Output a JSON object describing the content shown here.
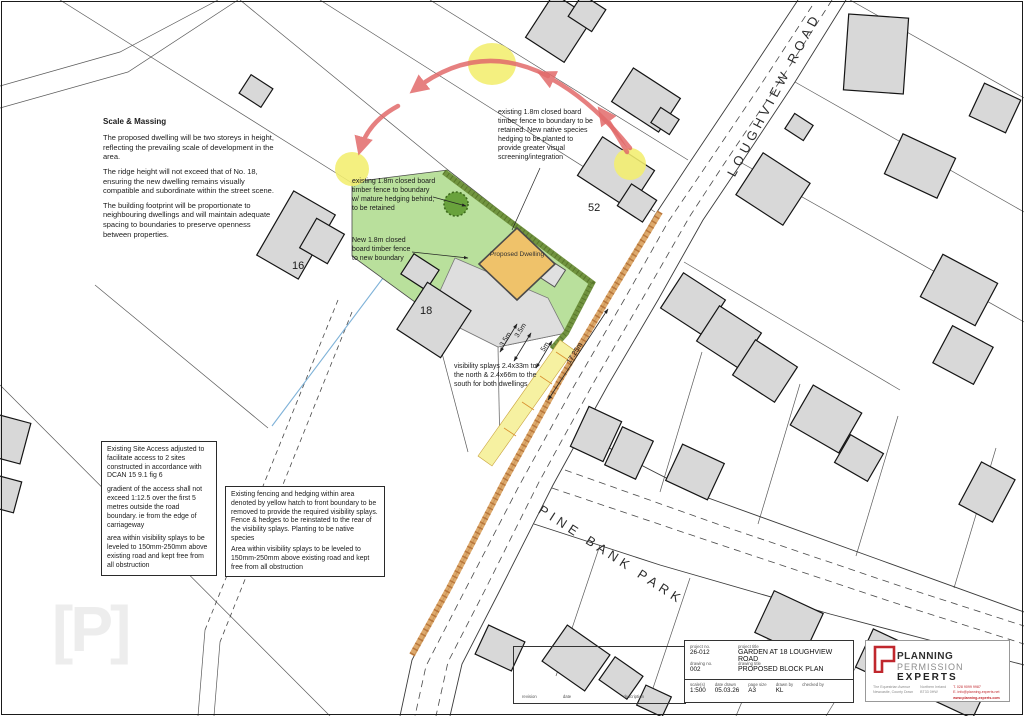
{
  "drawing": {
    "scale_massing": {
      "heading": "Scale & Massing",
      "p1": "The proposed dwelling will be two storeys in height, reflecting the prevailing scale of development in the area.",
      "p2": "The ridge height will not exceed that of No. 18, ensuring the new dwelling remains visually compatible and subordinate within the street scene.",
      "p3": "The building footprint will be proportionate to neighbouring dwellings and will maintain adequate spacing to boundaries to preserve openness between properties."
    },
    "notes": {
      "fence_retained": "existing 1.8m closed board timber fence to boundary to be retained. New native species hedging to be planted to provide greater visual screening/integration",
      "fence_mature": "existing 1.8m closed board timber fence to boundary w/ mature hedging behind, to be retained",
      "new_fence": "New 1.8m closed board timber fence to new boundary",
      "visibility": "visibility splays 2.4x33m to the north & 2.4x66m to the south for both dwellings"
    },
    "access_box": {
      "p1": "Existing Site  Access adjusted to facilitate access to 2 sites constructed in accordance with DCAN 15 9.1 fig 6",
      "p2": "gradient of the access shall not exceed 1:12.5 over the first 5 metres outside the road boundary. ie from the edge of carriageway",
      "p3": "area within visibility splays to be leveled to 150mm-250mm above existing road and kept free from all obstruction"
    },
    "fencing_box": {
      "p1": "Existing fencing and hedging within area denoted by yellow hatch to front boundary to be removed to provide the required visibility splays. Fence & hedges to be reinstated  to the rear of the visibility splays. Planting to be native species",
      "p2": "Area within visibility splays to be leveled to 150mm-250mm above existing road and kept free from all obstruction"
    },
    "roads": {
      "loughview": "LOUGHVIEW ROAD",
      "pine_bank": "PINE BANK PARK"
    },
    "houses": {
      "no16": "16",
      "no18": "18",
      "no52": "52"
    },
    "dwelling_label": "Proposed Dwelling",
    "dimensions": {
      "d1": "3.5m",
      "d2": "3.5m",
      "d3": "5m",
      "d4": "17.25m"
    },
    "watermark": "[P]"
  },
  "title_block": {
    "labels": {
      "project_no": "project no.",
      "project_title": "project title",
      "drawing_no": "drawing no.",
      "drawing_title": "drawing title",
      "scale": "scale(s)",
      "date": "date drawn",
      "page": "page size",
      "drawn": "drawn by",
      "checked": "checked by",
      "revision": "revision",
      "rev_date": "date",
      "description": "description"
    },
    "values": {
      "project_no": "26-012",
      "project_title": "GARDEN AT 18 LOUGHVIEW ROAD",
      "drawing_no": "002",
      "drawing_title": "PROPOSED BLOCK PLAN",
      "scale": "1:500",
      "date": "05.03.26",
      "page": "A3",
      "drawn": "KL",
      "checked": ""
    }
  },
  "logo": {
    "line1": "PLANNING",
    "line2": "PERMISSION",
    "line3": "EXPERTS",
    "addr1": "The Equestrian Avenue",
    "addr2": "Newcastle, County Down",
    "addr3": "Northern Ireland",
    "addr4": "BT33 0HW",
    "tel": "T. 028 9099 9987",
    "email": "E. info@planning-experts.net",
    "web": "www.planning-experts.com"
  },
  "colors": {
    "site_green": "#b9e09c",
    "hedge": "#6d8f3a",
    "dwelling": "#efc26a",
    "highlight": "#f2ee6e",
    "arrow": "#e26b6b",
    "road_strip": "#d9a05c",
    "hatch_yellow": "#f6f1a1",
    "boundary_blue": "#7fb2d8",
    "logo_red": "#c0272d"
  }
}
